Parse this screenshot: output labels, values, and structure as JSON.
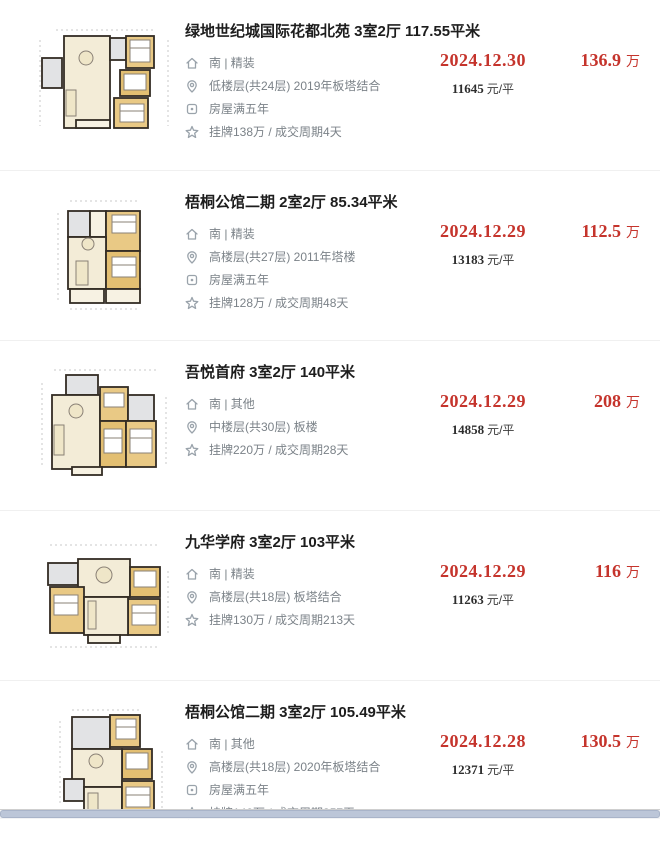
{
  "page": {
    "background": "#ffffff",
    "accent_red": "#c5342c",
    "text_dark": "#1d1d1d",
    "text_gray": "#7b8288",
    "separator_color": "#f0f0f0",
    "scrollbar_thumb_color": "#bcc6d8"
  },
  "icons": {
    "orientation": "house-icon",
    "floor": "location-pin-icon",
    "tax": "certificate-icon",
    "cycle": "star-icon"
  },
  "listings": [
    {
      "title": "绿地世纪城国际花都北苑 3室2厅 117.55平米",
      "orientation": "南 | 精装",
      "floor_info": "低楼层(共24层) 2019年板塔结合",
      "tax_info": "房屋满五年",
      "listing_info": "挂牌138万 / 成交周期4天",
      "deal_date": "2024.12.30",
      "unit_price": "11645",
      "unit_price_unit": "元/平",
      "total_price": "136.9",
      "total_price_unit": "万"
    },
    {
      "title": "梧桐公馆二期 2室2厅 85.34平米",
      "orientation": "南 | 精装",
      "floor_info": "高楼层(共27层) 2011年塔楼",
      "tax_info": "房屋满五年",
      "listing_info": "挂牌128万 / 成交周期48天",
      "deal_date": "2024.12.29",
      "unit_price": "13183",
      "unit_price_unit": "元/平",
      "total_price": "112.5",
      "total_price_unit": "万"
    },
    {
      "title": "吾悦首府 3室2厅 140平米",
      "orientation": "南 | 其他",
      "floor_info": "中楼层(共30层) 板楼",
      "listing_info": "挂牌220万 / 成交周期28天",
      "deal_date": "2024.12.29",
      "unit_price": "14858",
      "unit_price_unit": "元/平",
      "total_price": "208",
      "total_price_unit": "万"
    },
    {
      "title": "九华学府 3室2厅 103平米",
      "orientation": "南 | 精装",
      "floor_info": "高楼层(共18层) 板塔结合",
      "listing_info": "挂牌130万 / 成交周期213天",
      "deal_date": "2024.12.29",
      "unit_price": "11263",
      "unit_price_unit": "元/平",
      "total_price": "116",
      "total_price_unit": "万"
    },
    {
      "title": "梧桐公馆二期 3室2厅 105.49平米",
      "orientation": "南 | 其他",
      "floor_info": "高楼层(共18层) 2020年板塔结合",
      "tax_info": "房屋满五年",
      "listing_info": "挂牌140万 / 成交周期357天",
      "deal_date": "2024.12.28",
      "unit_price": "12371",
      "unit_price_unit": "元/平",
      "total_price": "130.5",
      "total_price_unit": "万"
    }
  ]
}
